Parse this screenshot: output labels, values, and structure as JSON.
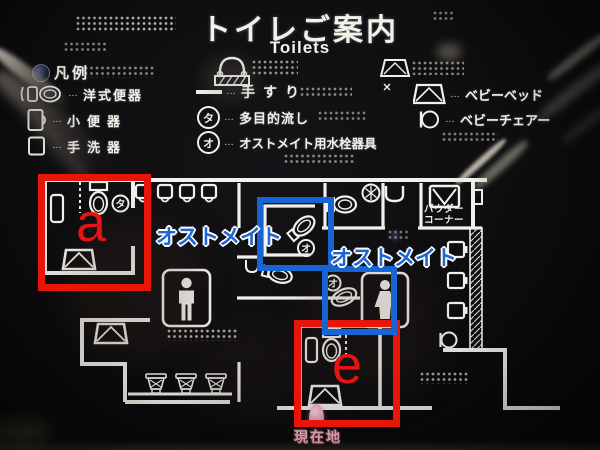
{
  "title": "トイレご案内",
  "subtitle": "Toilets",
  "legend": {
    "header": "凡例",
    "leader": "…",
    "items": [
      {
        "label": "洋式便器"
      },
      {
        "label": "小便器"
      },
      {
        "label": "手洗器"
      },
      {
        "label": "手すり"
      },
      {
        "label": "多目的流し",
        "badge": "タ"
      },
      {
        "label": "オストメイト用水栓器具",
        "badge": "オ"
      },
      {
        "label": "ベビーベッド"
      },
      {
        "label": "ベビーチェアー"
      }
    ]
  },
  "map": {
    "powder_corner_line1": "パウダー",
    "powder_corner_line2": "コーナー",
    "current_location": "現在地",
    "badge_ta": "タ",
    "badge_o": "オ"
  },
  "annotations": {
    "ostomate_label_1": "オストメイト",
    "ostomate_label_2": "オストメイト",
    "box_a_letter": "a",
    "box_e_letter": "e",
    "red_color": "#ea1509",
    "blue_box_color": "#1565d4",
    "blue_text_color": "#1e66d6"
  },
  "colors": {
    "sign_line": "#f1f0ea",
    "marker_pink": "#e8a3b6"
  }
}
